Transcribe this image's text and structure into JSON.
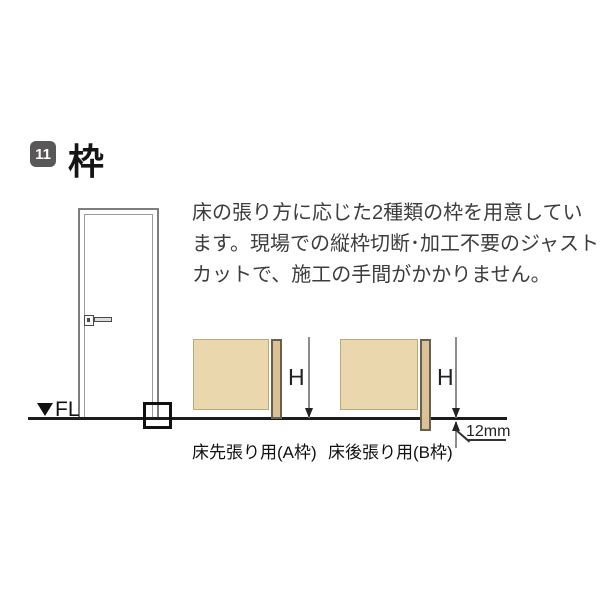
{
  "header": {
    "badge_number": "11",
    "title": "枠"
  },
  "description": {
    "line1": "床の張り方に応じた2種類の枠を用意してい",
    "line2": "ます。現場での縦枠切断･加工不要のジャスト",
    "line3": "カットで、施工の手間がかかりません。"
  },
  "door_elevation": {
    "floor_level_label": "FL"
  },
  "frame_sections": {
    "a": {
      "height_label": "H",
      "caption": "床先張り用(A枠)"
    },
    "b": {
      "height_label": "H",
      "caption": "床後張り用(B枠)",
      "offset_label": "12mm"
    }
  },
  "colors": {
    "badge_background": "#595757",
    "wall_fill": "#ebd7ae",
    "frame_strip_fill": "#dcc096",
    "frame_strip_border": "#66604f",
    "floor_line": "#1c1c1c",
    "text_body": "#3d3d3d"
  }
}
